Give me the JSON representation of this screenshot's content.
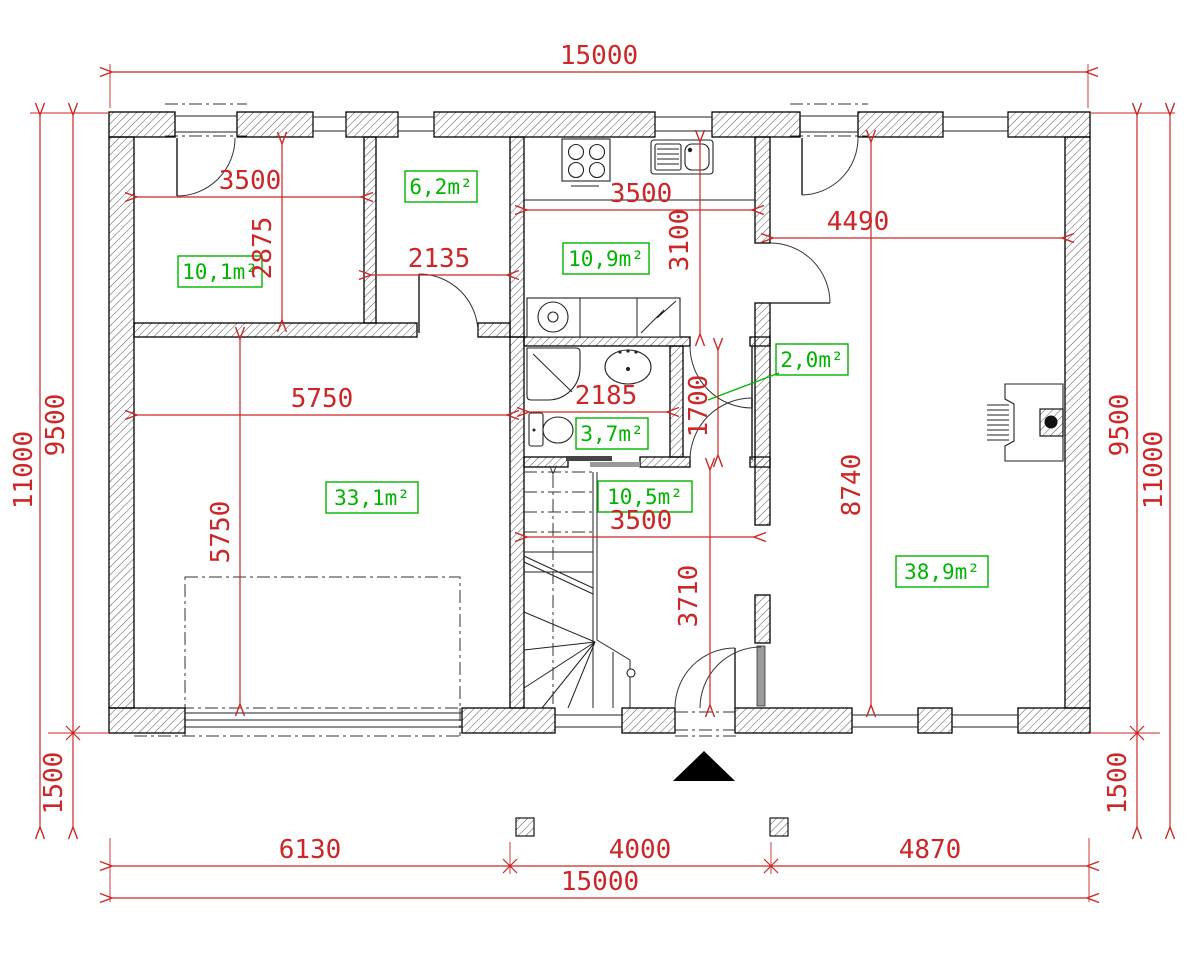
{
  "plan": {
    "type": "floor-plan",
    "colors": {
      "dimension": "#cc2626",
      "area_label": "#00b400",
      "walls": "#000000"
    },
    "areas": {
      "room_101": "10,1m²",
      "room_62": "6,2m²",
      "kitchen": "10,9m²",
      "hall_small": "2,0m²",
      "bathroom": "3,7m²",
      "living_small": "33,1m²",
      "hallway": "10,5m²",
      "living_large": "38,9m²"
    },
    "dims": {
      "top_width": "15000",
      "left_total": "11000",
      "left_main": "9500",
      "left_porch": "1500",
      "right_main": "9500",
      "right_total": "11000",
      "right_porch": "1500",
      "bottom_seg1": "6130",
      "bottom_seg2": "4000",
      "bottom_seg3": "4870",
      "bottom_total": "15000",
      "room101_w": "3500",
      "room101_h": "2875",
      "room62_w": "2135",
      "kitchen_w": "3500",
      "kitchen_h": "3100",
      "living_right_w": "4490",
      "living_right_h": "8740",
      "living_left_w": "5750",
      "living_left_h": "5750",
      "bath_w": "2185",
      "hall_small_h": "1700",
      "hallway_w": "3500",
      "hallway_h": "3710"
    }
  }
}
